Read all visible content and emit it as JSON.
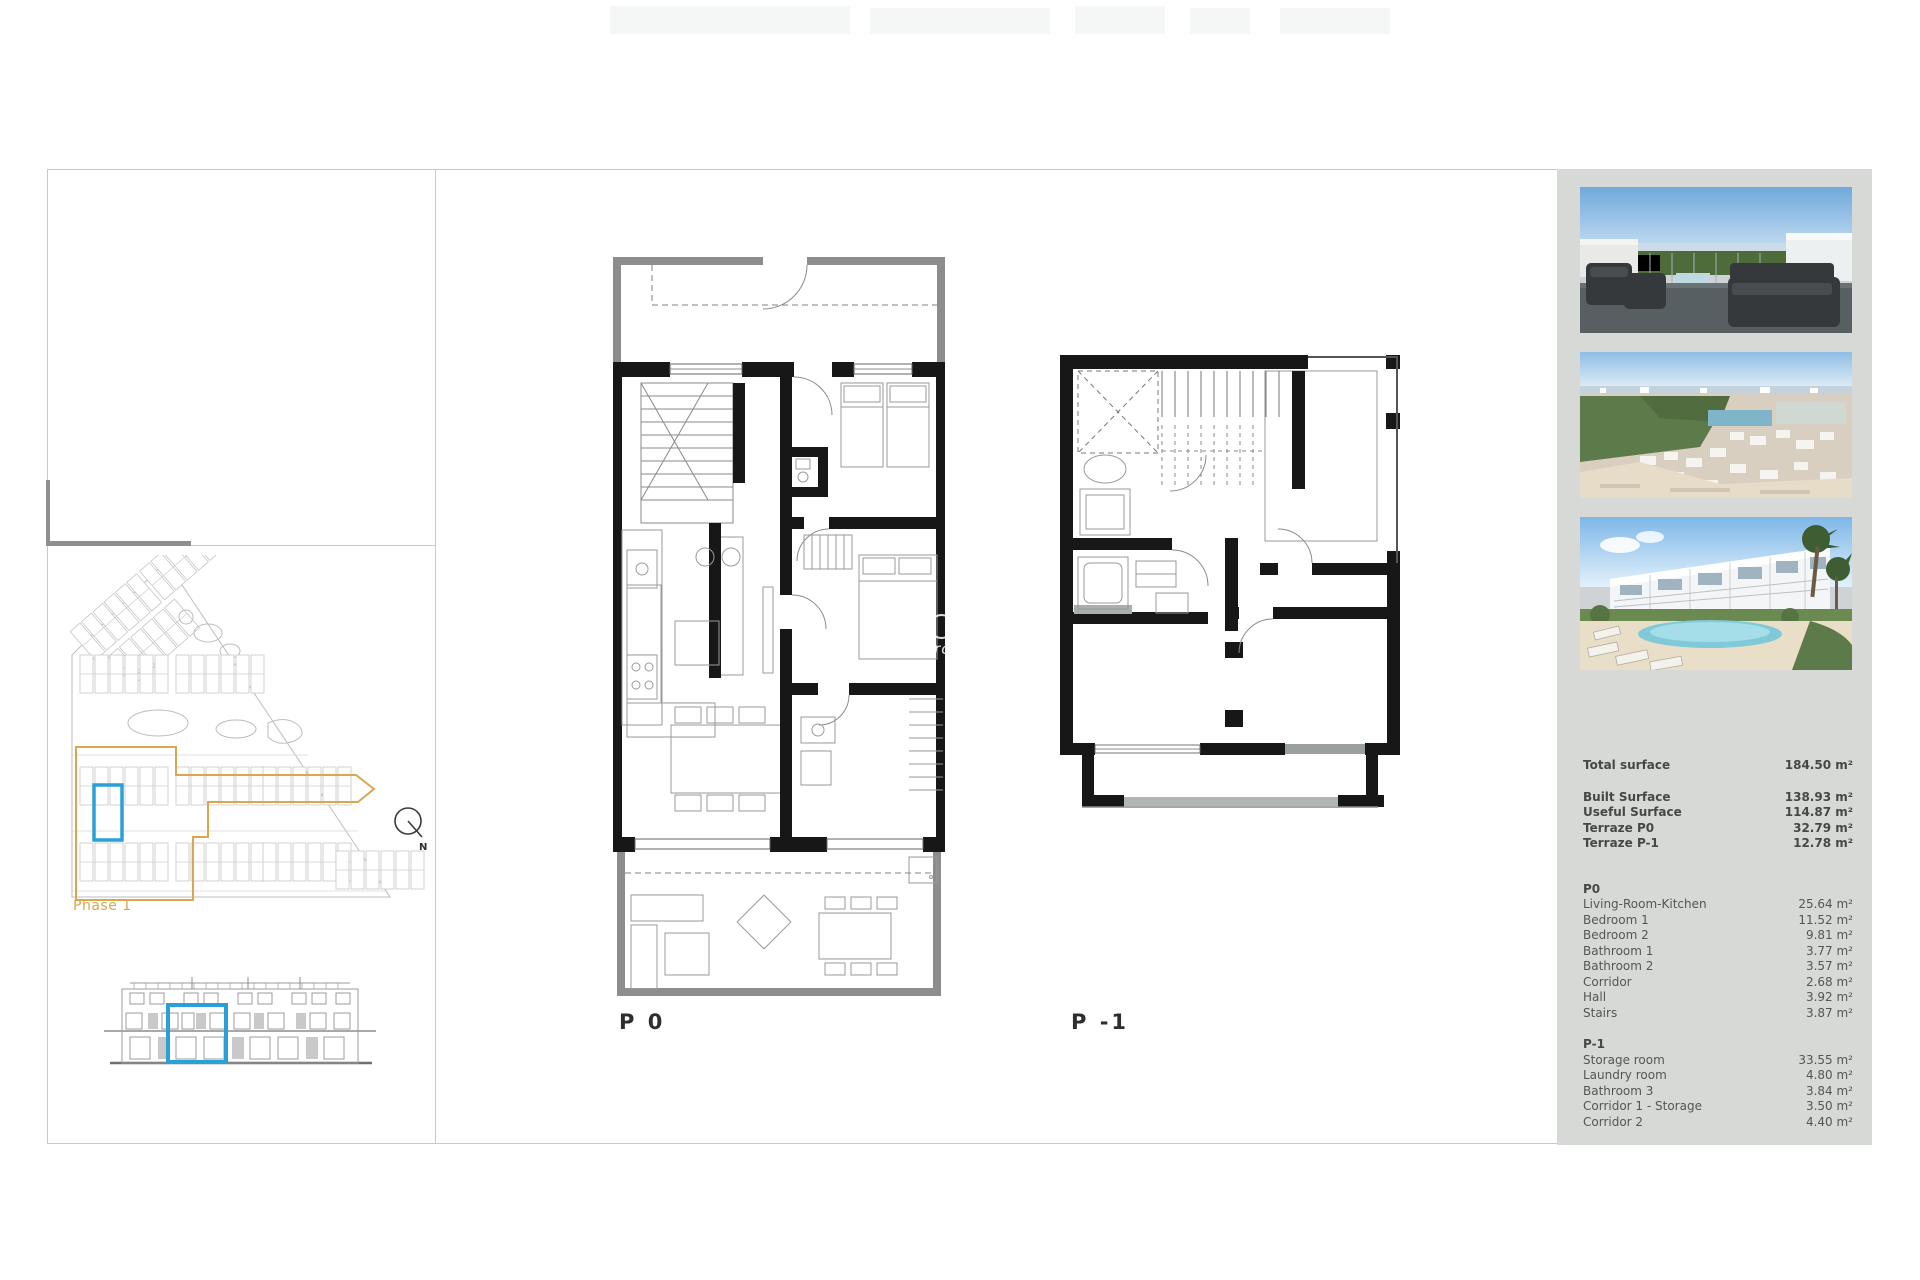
{
  "plan_labels": {
    "p0": "P 0",
    "p_minus_1": "P -1"
  },
  "site": {
    "phase_label": "Phase 1",
    "compass_n": "N"
  },
  "watermark": {
    "text": "Pro"
  },
  "colors": {
    "accent_blue": "#29a1d8",
    "phase_orange": "#d9a84e",
    "panel_bg": "#d7d9d7",
    "wall_black": "#171717",
    "outer_wall_grey": "#8d8d8d"
  },
  "photos": [
    {
      "name": "terrace-render"
    },
    {
      "name": "aerial-view-render"
    },
    {
      "name": "townhouses-pool-render"
    }
  ],
  "summary": {
    "total": {
      "label": "Total surface",
      "value": "184.50 m²"
    },
    "main_rows": [
      {
        "label": "Built Surface",
        "value": "138.93 m²"
      },
      {
        "label": "Useful Surface",
        "value": "114.87 m²"
      },
      {
        "label": "Terraze P0",
        "value": "32.79 m²"
      },
      {
        "label": "Terraze P-1",
        "value": "12.78 m²"
      }
    ],
    "p0": {
      "heading": "P0",
      "rooms": [
        {
          "label": "Living-Room-Kitchen",
          "value": "25.64 m²"
        },
        {
          "label": "Bedroom 1",
          "value": "11.52 m²"
        },
        {
          "label": "Bedroom 2",
          "value": "9.81 m²"
        },
        {
          "label": "Bathroom 1",
          "value": "3.77 m²"
        },
        {
          "label": "Bathroom 2",
          "value": "3.57 m²"
        },
        {
          "label": "Corridor",
          "value": "2.68 m²"
        },
        {
          "label": "Hall",
          "value": "3.92 m²"
        },
        {
          "label": "Stairs",
          "value": "3.87 m²"
        }
      ]
    },
    "p1": {
      "heading": "P-1",
      "rooms": [
        {
          "label": "Storage room",
          "value": "33.55 m²"
        },
        {
          "label": "Laundry room",
          "value": "4.80 m²"
        },
        {
          "label": "Bathroom 3",
          "value": "3.84 m²"
        },
        {
          "label": "Corridor 1 - Storage",
          "value": "3.50 m²"
        },
        {
          "label": "Corridor 2",
          "value": "4.40 m²"
        }
      ]
    }
  }
}
